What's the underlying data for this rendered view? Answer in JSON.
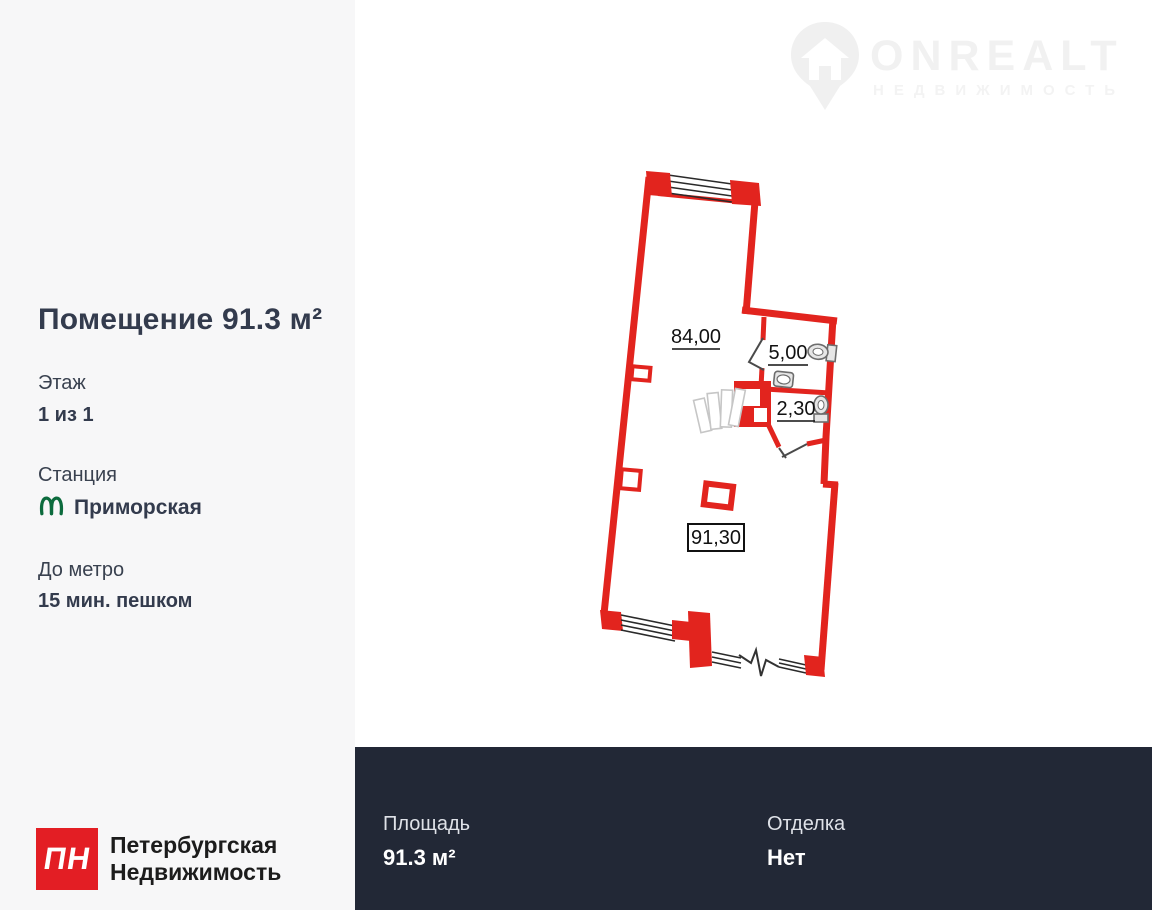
{
  "sidebar": {
    "title": "Помещение 91.3 м²",
    "floor": {
      "label": "Этаж",
      "value": "1 из 1"
    },
    "station": {
      "label": "Станция",
      "value": "Приморская"
    },
    "metro": {
      "label": "До метро",
      "value": "15 мин. пешком"
    },
    "logo": {
      "badge": "ПН",
      "line1": "Петербургская",
      "line2": "Недвижимость"
    }
  },
  "watermark": {
    "brand": "ONREALT",
    "subtitle": "НЕДВИЖИМОСТЬ"
  },
  "plan": {
    "room_main_area": "84,00",
    "room_wc_area": "5,00",
    "room_wc2_area": "2,30",
    "total_area": "91,30"
  },
  "footer": {
    "area": {
      "label": "Площадь",
      "value": "91.3 м²"
    },
    "finish": {
      "label": "Отделка",
      "value": "Нет"
    }
  },
  "colors": {
    "wall_red": "#e2241e",
    "footer_bg": "#222836",
    "sidebar_bg": "#f7f7f8",
    "metro_green": "#0c6b3d",
    "agency_red": "#e31e24",
    "watermark_gray": "#f1f1f1"
  }
}
